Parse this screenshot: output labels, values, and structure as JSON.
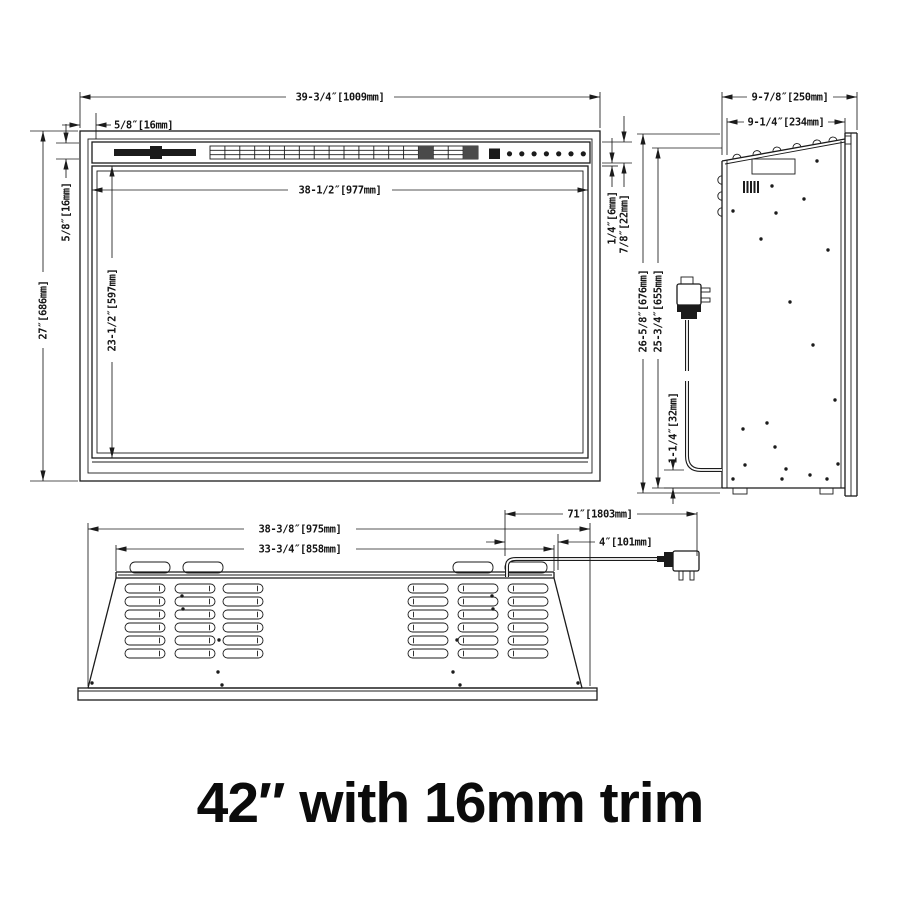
{
  "title": "42″ with 16mm trim",
  "drawing": {
    "front_view": {
      "dims": {
        "overall_width": "39-3/4″[1009mm]",
        "trim_width": "5/8″[16mm]",
        "inner_width": "38-1/2″[977mm]",
        "trim_height": "5/8″[16mm]",
        "overall_height": "27″[686mm]",
        "opening_height": "23-1/2″[597mm]",
        "glass_gap": "1/4″[6mm]",
        "top_bar_height": "7/8″[22mm]"
      },
      "controls": {
        "button_count": 7
      }
    },
    "side_view": {
      "dims": {
        "overall_depth": "9-7/8″[250mm]",
        "body_depth": "9-1/4″[234mm]",
        "overall_height": "26-5/8″[676mm]",
        "body_height": "25-3/4″[655mm]",
        "cord_clearance": "1-1/4″[32mm]"
      }
    },
    "bottom_view": {
      "dims": {
        "base_width": "38-3/8″[975mm]",
        "vent_width": "33-3/4″[858mm]",
        "cord_length": "71″[1803mm]",
        "cord_offset": "4″[101mm]"
      }
    }
  }
}
